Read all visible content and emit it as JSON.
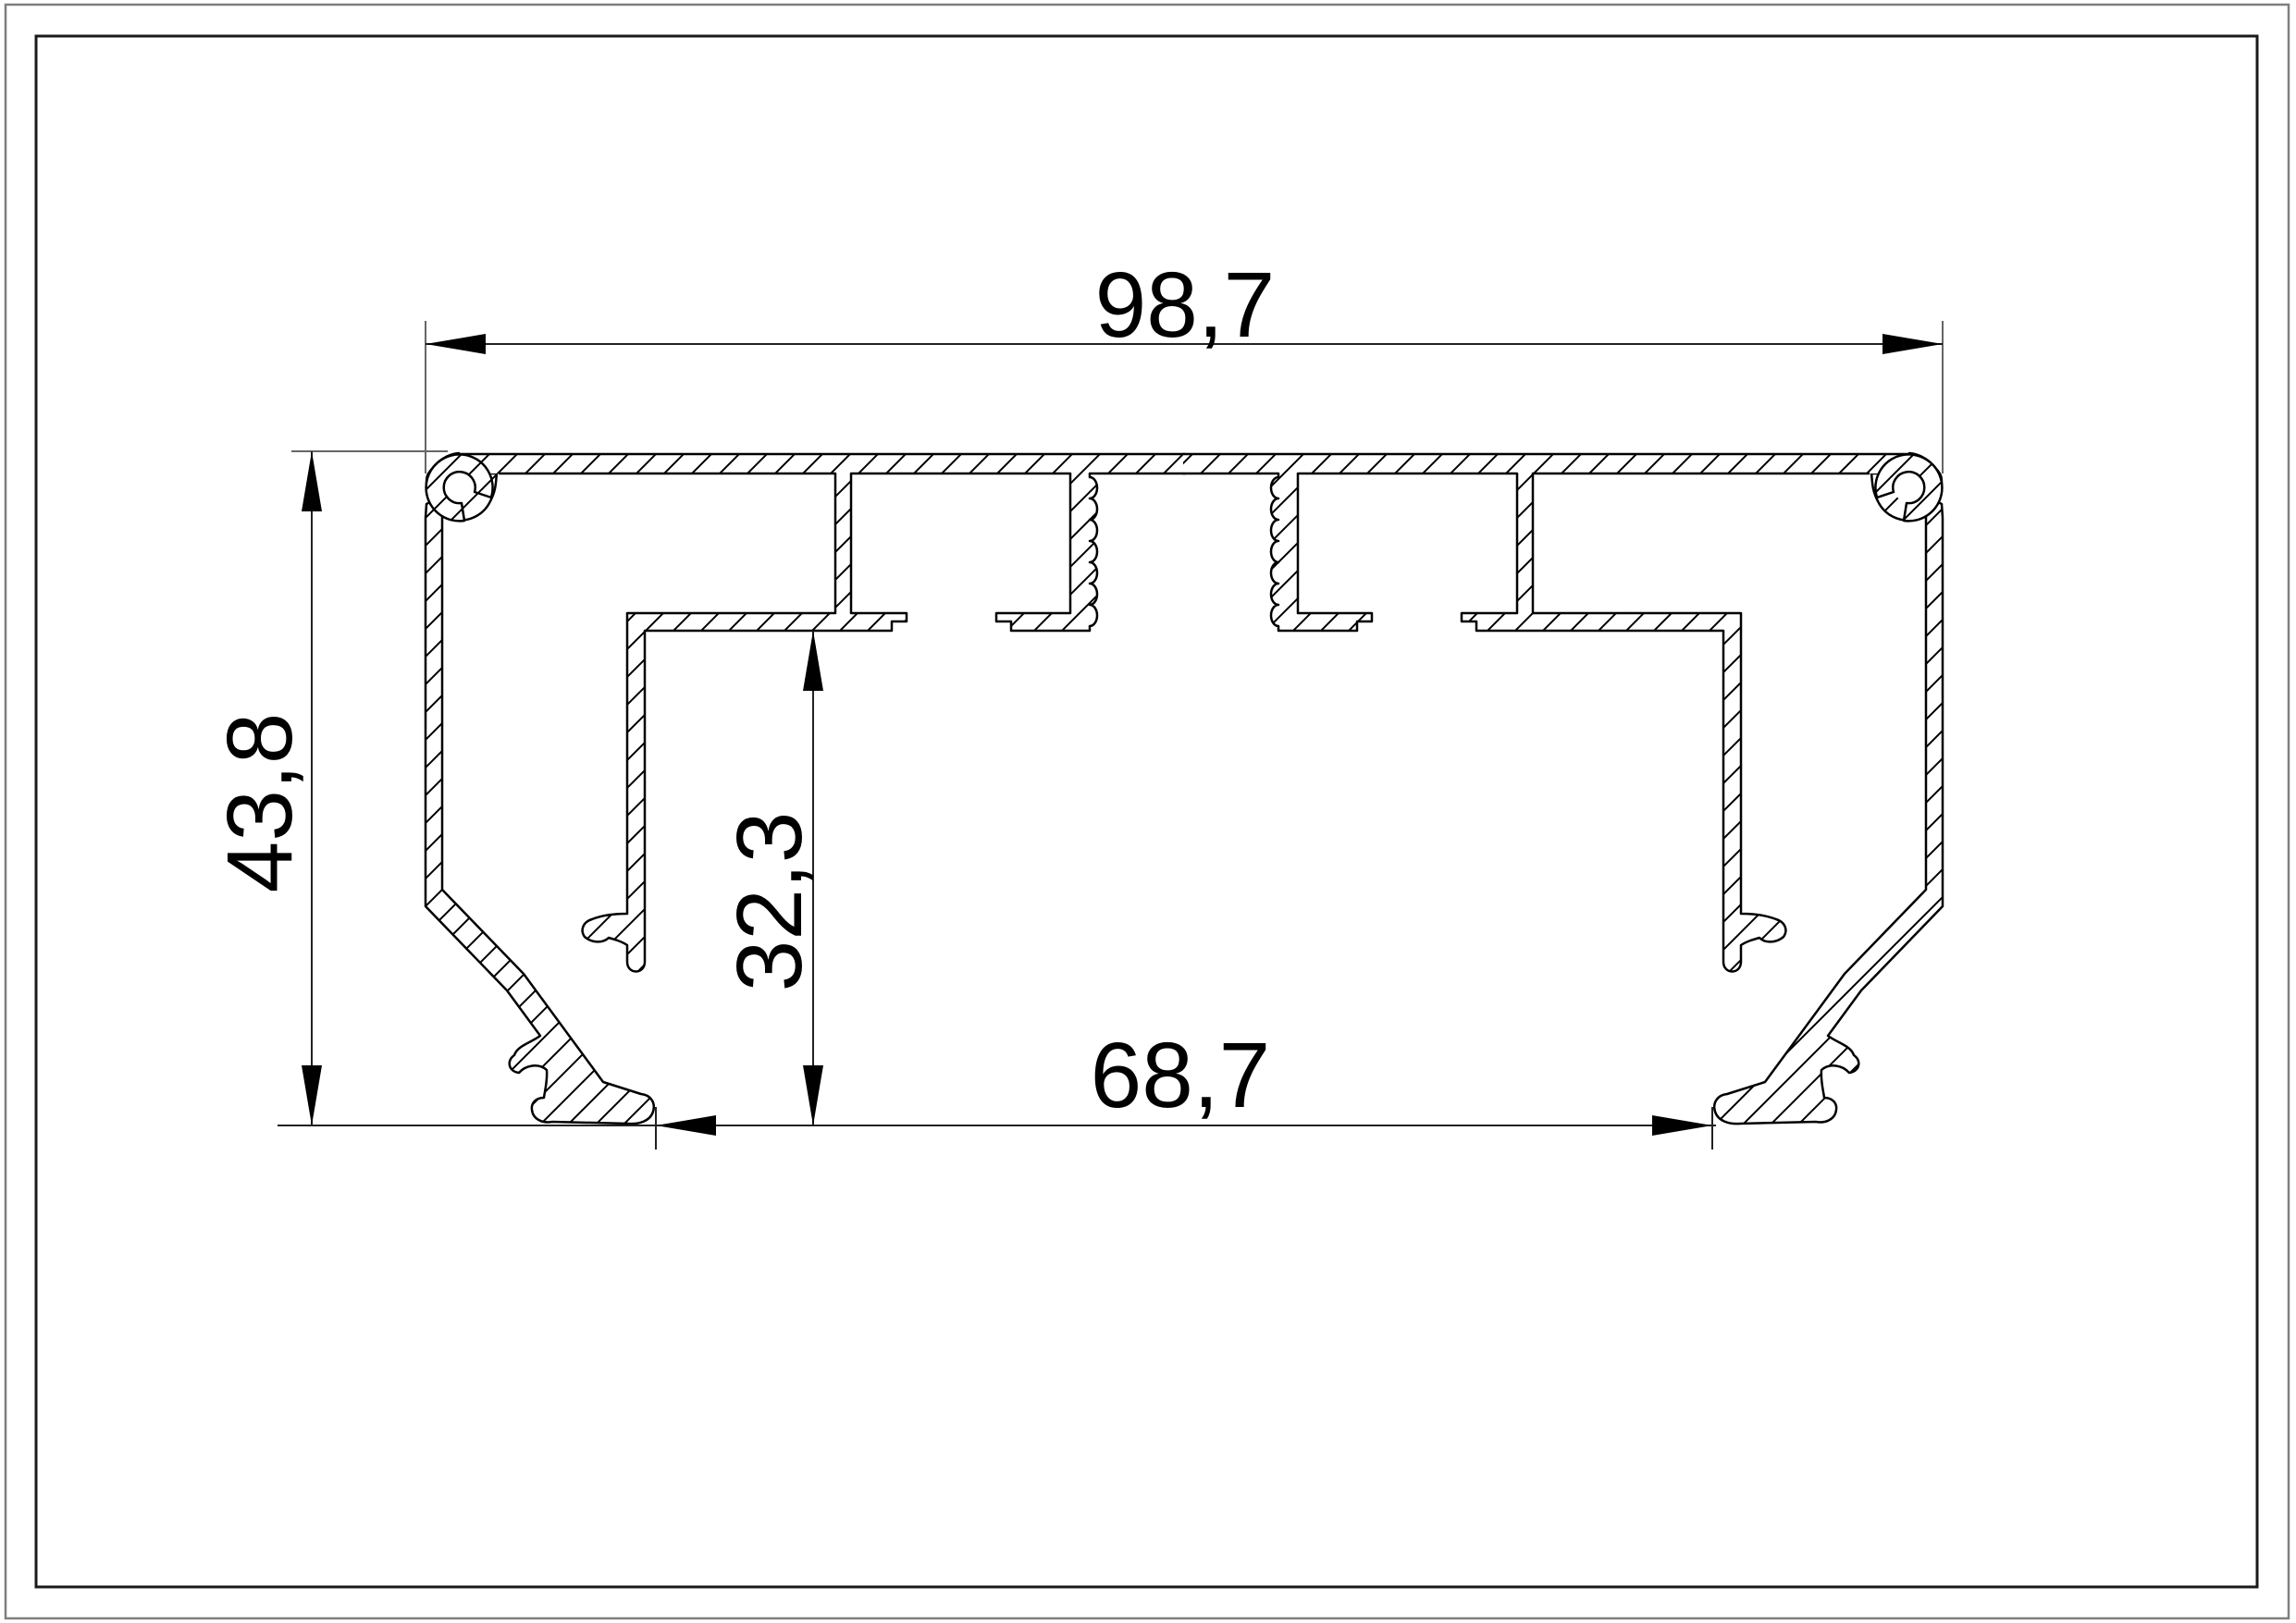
{
  "sheet": {
    "background": "#ffffff",
    "frame_outer_color": "#7f7f7f",
    "frame_inner_color": "#1a1a1a"
  },
  "drawing": {
    "description": "aluminium-profile-cross-section",
    "outline_color": "#000000",
    "dim_line_color": "#222222",
    "ext_line_color": "#666666",
    "hatch_color": "#000000",
    "dimensions": {
      "width_top": "98,7",
      "height_left": "43,8",
      "height_inner": "32,3",
      "width_bottom": "68,7"
    }
  }
}
